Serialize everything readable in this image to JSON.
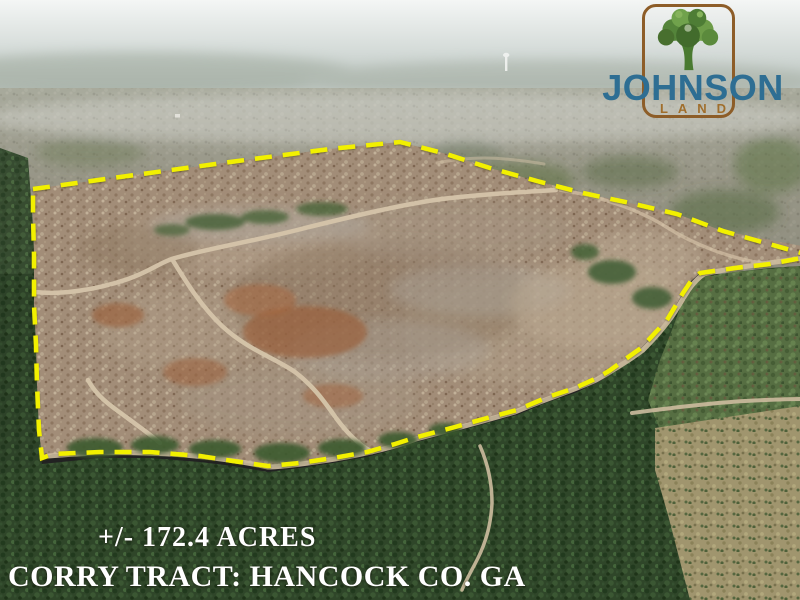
{
  "logo": {
    "brand": "JOHNSON",
    "division": "LAND",
    "icon": "oak-tree-icon",
    "brand_color": "#2e6e93",
    "division_color": "#a06e2c",
    "frame_color": "#8d5d28"
  },
  "captions": {
    "acreage": "+/- 172.4 ACRES",
    "tract": "CORRY TRACT: HANCOCK CO. GA",
    "text_color": "#ffffff"
  },
  "boundary": {
    "color": "#f2f000",
    "style": "dashed",
    "meaning": "property-tract-outline"
  },
  "scene": {
    "description": "Aerial photograph of a partially clear-cut timber tract outlined in yellow, surrounded by pine forest",
    "features": [
      "clear-cut ground",
      "red clay logging roads",
      "pine forest",
      "hazy horizon",
      "water tower"
    ]
  }
}
